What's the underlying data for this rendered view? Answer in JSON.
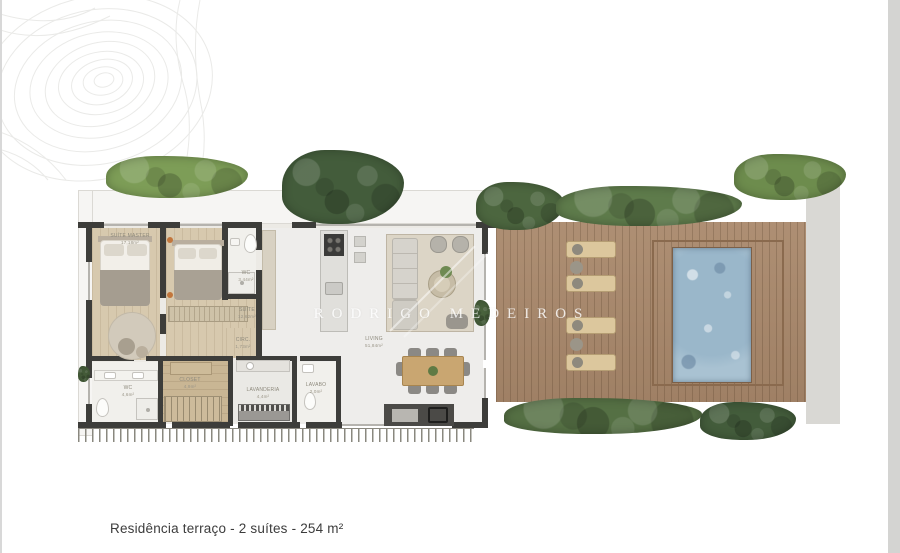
{
  "caption": {
    "text": "Residência terraço - 2 suítes - 254 m²"
  },
  "watermark": {
    "text": "RODRIGO MEDEIROS"
  },
  "rooms": [
    {
      "label": "SUÍTE MASTER",
      "area": "17,18m²"
    },
    {
      "label": "WC",
      "area": "3,44m²"
    },
    {
      "label": "SUÍTE",
      "area": "12,62m²"
    },
    {
      "label": "CIRC.",
      "area": "1,73m²"
    },
    {
      "label": "LIVING",
      "area": "51,84m²"
    },
    {
      "label": "WC",
      "area": "4,6m²"
    },
    {
      "label": "CLOSET",
      "area": "4,9m²"
    },
    {
      "label": "LAVANDERIA",
      "area": "4,4m²"
    },
    {
      "label": "LAVABO",
      "area": "2,0m²"
    }
  ],
  "colors": {
    "wall": "#3d3d3a",
    "wood-floor": "#d7c9ae",
    "wood-floor-dark": "#c9b694",
    "deck-wood": "#a9886b",
    "deck-frame": "#8a6a4e",
    "pool-water": "#a9c2d2",
    "hedge-dark": "#435c3b",
    "hedge-mid": "#5e7b4b",
    "grass-bright": "#7d9d57",
    "concrete-path": "#d9d8d4",
    "caption-text": "#3c3c3c",
    "label-text": "#8d897c",
    "watermark-text": "#ffffff"
  }
}
